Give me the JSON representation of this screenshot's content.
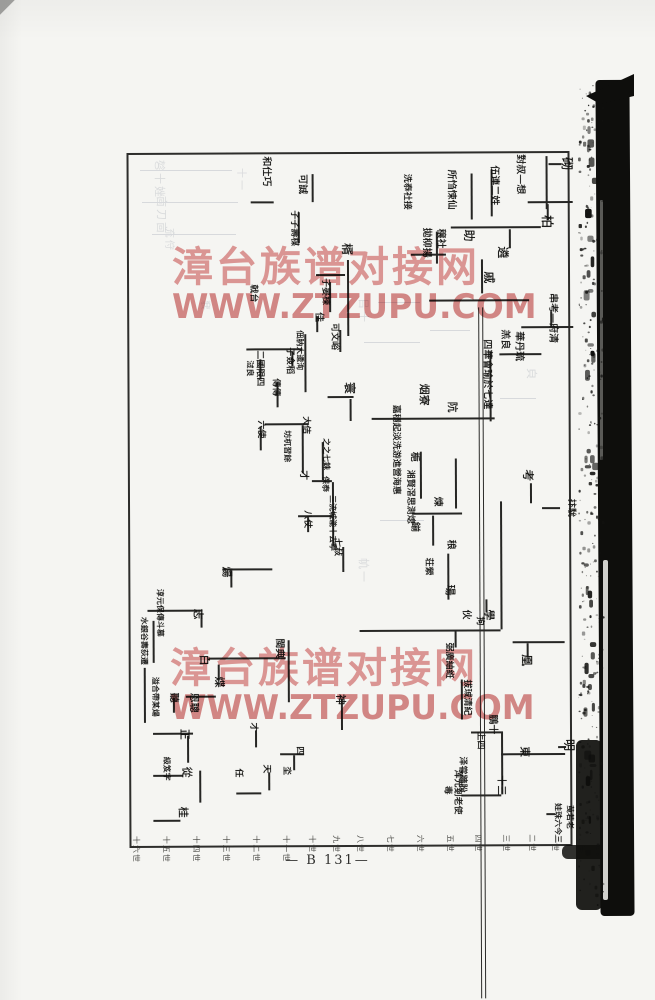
{
  "page": {
    "page_number": "— B 131—",
    "background": "#f5f5f2",
    "ink_color": "#141412"
  },
  "watermark": {
    "line1": "漳台族谱对接网",
    "line2": "WWW.ZTZUPU.COM",
    "color": "#de8989",
    "positions": [
      {
        "x": 172,
        "y": 233
      },
      {
        "x": 170,
        "y": 634
      }
    ]
  },
  "chart": {
    "frame": {
      "x": 128,
      "y": 152,
      "w": 443,
      "h": 695
    },
    "divider_x": 349,
    "labels": [
      [
        572,
        156,
        13,
        "砌"
      ],
      [
        524,
        153,
        10,
        "對叔—想"
      ],
      [
        498,
        164,
        10,
        "伍連二姓"
      ],
      [
        552,
        214,
        13,
        "柏"
      ],
      [
        455,
        168,
        10,
        "所㤘悚仙"
      ],
      [
        410,
        172,
        9,
        "洗㤗社接"
      ],
      [
        430,
        226,
        10,
        "拋柳揚"
      ],
      [
        444,
        227,
        10,
        "穣社"
      ],
      [
        474,
        228,
        12,
        "助"
      ],
      [
        508,
        245,
        12,
        "遴"
      ],
      [
        494,
        270,
        12,
        "戚"
      ],
      [
        556,
        292,
        10,
        "串考—府清"
      ],
      [
        508,
        328,
        10,
        "羔良"
      ],
      [
        522,
        330,
        10,
        "華丹琉"
      ],
      [
        490,
        338,
        10,
        "四華會瑜於七達"
      ],
      [
        456,
        400,
        11,
        "阬"
      ],
      [
        428,
        382,
        11,
        "烟寮"
      ],
      [
        398,
        403,
        9,
        "嘉穩起淡洗游進營海惠"
      ],
      [
        412,
        468,
        9,
        "湘賢滘思測熄"
      ],
      [
        417,
        450,
        10,
        "梔"
      ],
      [
        440,
        495,
        10,
        "煉"
      ],
      [
        417,
        520,
        10,
        "鎆"
      ],
      [
        453,
        538,
        10,
        "稂"
      ],
      [
        430,
        556,
        9,
        "荘縈"
      ],
      [
        453,
        583,
        11,
        "瑒"
      ],
      [
        468,
        608,
        10,
        "伙"
      ],
      [
        492,
        608,
        11,
        "學"
      ],
      [
        481,
        615,
        9,
        "拘"
      ],
      [
        532,
        468,
        12,
        "考"
      ],
      [
        573,
        498,
        9,
        "抃馻"
      ],
      [
        530,
        653,
        12,
        "凰"
      ],
      [
        450,
        641,
        9,
        "弼廣紬絍"
      ],
      [
        468,
        678,
        9,
        "拔珹清紀"
      ],
      [
        494,
        713,
        10,
        "鵬十"
      ],
      [
        481,
        730,
        9,
        "上四"
      ],
      [
        527,
        745,
        11,
        "東"
      ],
      [
        572,
        738,
        12,
        "明"
      ],
      [
        463,
        755,
        9,
        "泽甞牆朌"
      ],
      [
        458,
        768,
        9,
        "浑元剗老使"
      ],
      [
        448,
        784,
        9,
        "毒"
      ],
      [
        502,
        774,
        10,
        "十三"
      ],
      [
        558,
        802,
        8,
        "娃珠六今三"
      ],
      [
        570,
        804,
        8,
        "䒶若老"
      ],
      [
        270,
        154,
        10,
        "和仕巧"
      ],
      [
        306,
        172,
        10,
        "可誠"
      ],
      [
        297,
        208,
        9,
        "子子壽楳"
      ],
      [
        352,
        241,
        12,
        "楈"
      ],
      [
        328,
        276,
        9,
        "子晏楝"
      ],
      [
        256,
        282,
        9,
        "戟台"
      ],
      [
        322,
        310,
        10,
        "佳"
      ],
      [
        302,
        328,
        8,
        "佃肭大逶洵"
      ],
      [
        337,
        321,
        9,
        "可文峪"
      ],
      [
        354,
        380,
        12,
        "寰"
      ],
      [
        292,
        345,
        9,
        "子僉稻"
      ],
      [
        262,
        348,
        9,
        "二國限四"
      ],
      [
        278,
        376,
        9,
        "傳傳"
      ],
      [
        252,
        358,
        8,
        "㳡良"
      ],
      [
        308,
        414,
        9,
        "大佶"
      ],
      [
        328,
        436,
        8,
        "之之七銖"
      ],
      [
        289,
        428,
        8,
        "坊杌習餘"
      ],
      [
        306,
        468,
        10,
        "才"
      ],
      [
        263,
        418,
        9,
        "六使"
      ],
      [
        327,
        474,
        8,
        "保㤗"
      ],
      [
        334,
        493,
        8,
        "三㳘城㴰十去寕"
      ],
      [
        345,
        496,
        8,
        "𡉵甲堂工寗"
      ],
      [
        309,
        508,
        9,
        "八仗"
      ],
      [
        339,
        536,
        9,
        "七敊"
      ],
      [
        230,
        564,
        11,
        "煬"
      ],
      [
        201,
        606,
        11,
        "志"
      ],
      [
        281,
        636,
        10,
        "閩典"
      ],
      [
        207,
        652,
        11,
        "白"
      ],
      [
        222,
        674,
        11,
        "煠"
      ],
      [
        195,
        690,
        10,
        "恩聰"
      ],
      [
        187,
        726,
        11,
        "正"
      ],
      [
        189,
        764,
        11,
        "從"
      ],
      [
        185,
        804,
        11,
        "桂"
      ],
      [
        175,
        690,
        10,
        "聽"
      ],
      [
        161,
        586,
        8,
        "淳元保傳斗慕"
      ],
      [
        145,
        614,
        8,
        "水銀谷夀荻遷"
      ],
      [
        156,
        674,
        8,
        "溢合帶某煬"
      ],
      [
        167,
        754,
        8,
        "級笈字"
      ],
      [
        343,
        692,
        11,
        "神"
      ],
      [
        239,
        766,
        9,
        "任"
      ],
      [
        267,
        762,
        9,
        "天"
      ],
      [
        287,
        764,
        9,
        "坔"
      ],
      [
        300,
        744,
        9,
        "四"
      ],
      [
        254,
        720,
        9,
        "才"
      ]
    ],
    "lines": [
      [
        545,
        155,
        53,
        "v"
      ],
      [
        548,
        162,
        13,
        "h"
      ],
      [
        527,
        200,
        45,
        "h"
      ],
      [
        546,
        203,
        16,
        "v"
      ],
      [
        490,
        168,
        47,
        "v"
      ],
      [
        470,
        172,
        46,
        "v"
      ],
      [
        450,
        225,
        90,
        "h"
      ],
      [
        508,
        228,
        19,
        "v"
      ],
      [
        480,
        258,
        34,
        "v"
      ],
      [
        435,
        230,
        32,
        "v"
      ],
      [
        410,
        252,
        35,
        "h"
      ],
      [
        428,
        298,
        100,
        "h"
      ],
      [
        520,
        325,
        52,
        "h"
      ],
      [
        549,
        310,
        16,
        "v"
      ],
      [
        498,
        352,
        42,
        "h"
      ],
      [
        488,
        350,
        70,
        "v"
      ],
      [
        370,
        416,
        123,
        "h"
      ],
      [
        418,
        450,
        47,
        "v"
      ],
      [
        453,
        457,
        50,
        "v"
      ],
      [
        410,
        511,
        50,
        "h"
      ],
      [
        430,
        514,
        30,
        "v"
      ],
      [
        445,
        552,
        46,
        "v"
      ],
      [
        357,
        628,
        141,
        "h"
      ],
      [
        498,
        500,
        128,
        "v"
      ],
      [
        483,
        598,
        13,
        "v"
      ],
      [
        510,
        640,
        52,
        "h"
      ],
      [
        524,
        642,
        14,
        "v"
      ],
      [
        452,
        630,
        16,
        "v"
      ],
      [
        458,
        678,
        40,
        "v"
      ],
      [
        468,
        730,
        30,
        "h"
      ],
      [
        498,
        730,
        63,
        "v"
      ],
      [
        498,
        752,
        64,
        "h"
      ],
      [
        555,
        745,
        8,
        "h"
      ],
      [
        458,
        793,
        40,
        "h"
      ],
      [
        543,
        812,
        9,
        "h"
      ],
      [
        528,
        482,
        20,
        "v"
      ],
      [
        540,
        506,
        18,
        "h"
      ],
      [
        311,
        172,
        28,
        "v"
      ],
      [
        250,
        199,
        23,
        "h"
      ],
      [
        297,
        210,
        31,
        "v"
      ],
      [
        346,
        258,
        76,
        "v"
      ],
      [
        315,
        272,
        29,
        "h"
      ],
      [
        328,
        280,
        30,
        "v"
      ],
      [
        315,
        314,
        16,
        "v"
      ],
      [
        303,
        332,
        58,
        "v"
      ],
      [
        338,
        328,
        22,
        "v"
      ],
      [
        326,
        394,
        26,
        "h"
      ],
      [
        348,
        397,
        22,
        "v"
      ],
      [
        245,
        346,
        56,
        "h"
      ],
      [
        290,
        349,
        15,
        "v"
      ],
      [
        258,
        357,
        20,
        "v"
      ],
      [
        275,
        380,
        25,
        "v"
      ],
      [
        263,
        421,
        44,
        "h"
      ],
      [
        300,
        423,
        48,
        "v"
      ],
      [
        258,
        424,
        24,
        "v"
      ],
      [
        320,
        440,
        38,
        "v"
      ],
      [
        310,
        478,
        20,
        "h"
      ],
      [
        330,
        480,
        64,
        "v"
      ],
      [
        296,
        513,
        34,
        "h"
      ],
      [
        305,
        515,
        15,
        "v"
      ],
      [
        340,
        545,
        25,
        "v"
      ],
      [
        220,
        566,
        50,
        "h"
      ],
      [
        228,
        568,
        17,
        "v"
      ],
      [
        145,
        607,
        55,
        "h"
      ],
      [
        198,
        610,
        15,
        "v"
      ],
      [
        285,
        638,
        62,
        "v"
      ],
      [
        206,
        655,
        77,
        "h"
      ],
      [
        215,
        662,
        16,
        "v"
      ],
      [
        183,
        693,
        30,
        "h"
      ],
      [
        170,
        695,
        15,
        "v"
      ],
      [
        150,
        618,
        42,
        "v"
      ],
      [
        141,
        665,
        55,
        "v"
      ],
      [
        150,
        730,
        40,
        "h"
      ],
      [
        184,
        733,
        27,
        "v"
      ],
      [
        150,
        772,
        30,
        "h"
      ],
      [
        196,
        768,
        32,
        "v"
      ],
      [
        150,
        817,
        27,
        "h"
      ],
      [
        233,
        790,
        25,
        "h"
      ],
      [
        265,
        770,
        18,
        "v"
      ],
      [
        277,
        751,
        24,
        "h"
      ],
      [
        290,
        753,
        15,
        "v"
      ],
      [
        252,
        728,
        17,
        "v"
      ],
      [
        338,
        697,
        31,
        "v"
      ]
    ],
    "generation_ticks": {
      "y": 833,
      "left_xs": [
        138,
        168,
        198,
        228,
        258,
        288,
        314,
        338
      ],
      "left_labels": [
        "十六世",
        "十五世",
        "十四世",
        "十三世",
        "十二世",
        "十一世",
        "十世",
        "九世"
      ],
      "right_xs": [
        362,
        392,
        422,
        452,
        480,
        508,
        534,
        557
      ],
      "right_labels": [
        "八世",
        "七世",
        "六世",
        "五世",
        "四世",
        "三世",
        "二世",
        "一世"
      ]
    }
  },
  "ghost_bleedthrough": {
    "texts": [
      [
        168,
        160,
        11,
        "㫈十㛗"
      ],
      [
        170,
        196,
        11,
        "㐭刀㐭"
      ],
      [
        178,
        228,
        10,
        "㐬㑏"
      ],
      [
        250,
        168,
        10,
        "十一"
      ],
      [
        372,
        298,
        11,
        "㠯十"
      ],
      [
        540,
        368,
        11,
        "㒵"
      ],
      [
        372,
        558,
        11,
        "㠶一"
      ],
      [
        214,
        300,
        10,
        "㐮"
      ]
    ],
    "dashes": [
      [
        140,
        170,
        92
      ],
      [
        142,
        202,
        96
      ],
      [
        152,
        234,
        84
      ],
      [
        364,
        342,
        56
      ],
      [
        378,
        302,
        42
      ],
      [
        430,
        330,
        40
      ],
      [
        500,
        398,
        36
      ],
      [
        380,
        520,
        44
      ]
    ]
  },
  "scan_band": {
    "x_core": 598,
    "width_core": 34,
    "y_top": 76,
    "y_bottom": 916,
    "white_streak": {
      "x": 603,
      "y": 560,
      "w": 5,
      "h": 340
    },
    "color": "#0e0e0c"
  }
}
